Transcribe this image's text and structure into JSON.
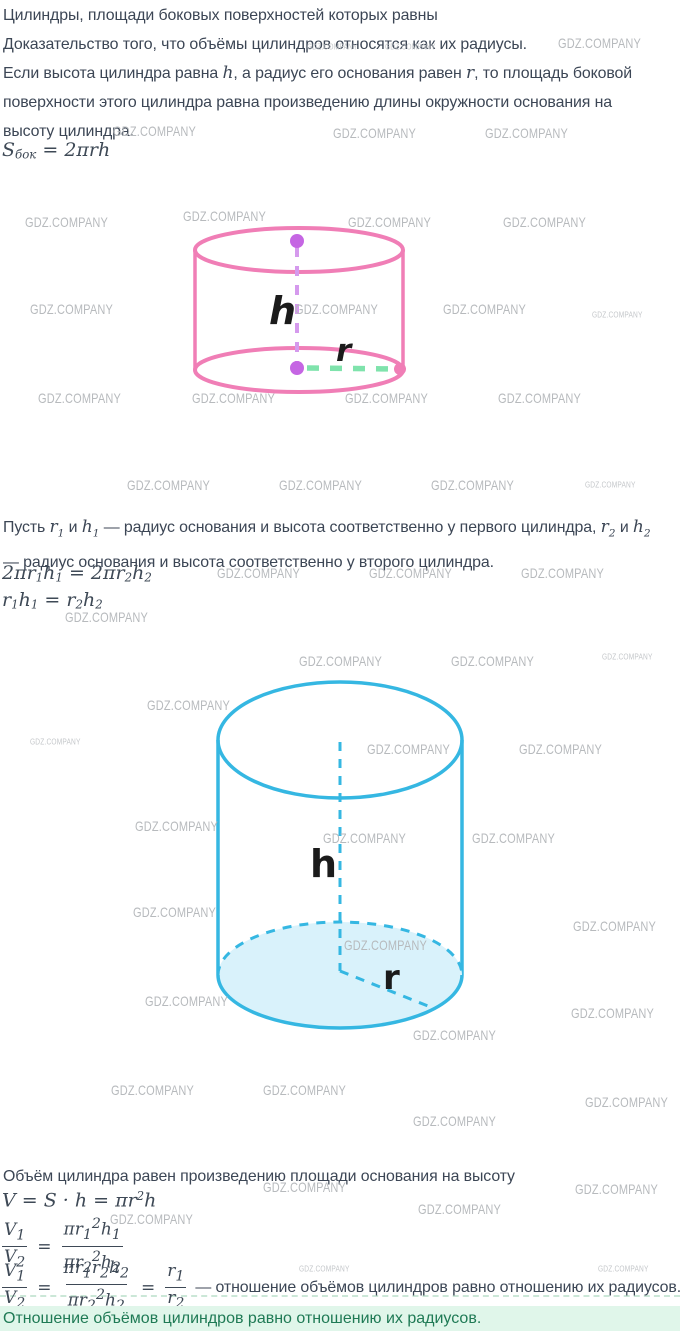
{
  "watermarks": {
    "text": "GDZ.COMPANY",
    "items": [
      [
        307,
        42,
        1
      ],
      [
        385,
        42,
        1
      ],
      [
        558,
        36,
        0
      ],
      [
        113,
        124,
        0
      ],
      [
        333,
        126,
        0
      ],
      [
        485,
        126,
        0
      ],
      [
        25,
        215,
        0
      ],
      [
        183,
        209,
        0
      ],
      [
        348,
        215,
        0
      ],
      [
        503,
        215,
        0
      ],
      [
        30,
        302,
        0
      ],
      [
        295,
        302,
        0
      ],
      [
        443,
        302,
        0
      ],
      [
        592,
        310,
        1
      ],
      [
        38,
        391,
        0
      ],
      [
        192,
        391,
        0
      ],
      [
        345,
        391,
        0
      ],
      [
        498,
        391,
        0
      ],
      [
        127,
        478,
        0
      ],
      [
        279,
        478,
        0
      ],
      [
        431,
        478,
        0
      ],
      [
        585,
        480,
        1
      ],
      [
        217,
        566,
        0
      ],
      [
        369,
        566,
        0
      ],
      [
        521,
        566,
        0
      ],
      [
        65,
        610,
        0
      ],
      [
        299,
        654,
        0
      ],
      [
        451,
        654,
        0
      ],
      [
        602,
        652,
        1
      ],
      [
        147,
        698,
        0
      ],
      [
        30,
        737,
        1
      ],
      [
        367,
        742,
        0
      ],
      [
        519,
        742,
        0
      ],
      [
        135,
        819,
        0
      ],
      [
        323,
        831,
        0
      ],
      [
        472,
        831,
        0
      ],
      [
        133,
        905,
        0
      ],
      [
        573,
        919,
        0
      ],
      [
        344,
        938,
        0
      ],
      [
        145,
        994,
        0
      ],
      [
        571,
        1006,
        0
      ],
      [
        413,
        1028,
        0
      ],
      [
        111,
        1083,
        0
      ],
      [
        263,
        1083,
        0
      ],
      [
        585,
        1095,
        0
      ],
      [
        413,
        1114,
        0
      ],
      [
        263,
        1180,
        0
      ],
      [
        575,
        1182,
        0
      ],
      [
        418,
        1202,
        0
      ],
      [
        110,
        1212,
        0
      ],
      [
        299,
        1264,
        1
      ],
      [
        598,
        1264,
        1
      ]
    ]
  },
  "intro": {
    "line1": "Цилиндры, площади боковых поверхностей которых равны",
    "line2": "Доказательство того, что объёмы цилиндров относятся как их радиусы.",
    "line3_pre": "Если высота цилиндра равна ",
    "var_h": "h",
    "line3_mid": ", а радиус его основания равен ",
    "var_r": "r",
    "line3_post": ", то площадь боковой",
    "line4": "поверхности этого цилиндра равна произведению длины окружности основания на",
    "line5": "высоту цилиндра."
  },
  "middle": {
    "line1_pre": "Пусть ",
    "var_r1": "r_1",
    "and1": " и ",
    "var_h1": "h_1",
    "line1_mid": " — радиус основания и высота соответственно у первого цилиндра, ",
    "var_r2": "r_2",
    "and2": " и ",
    "var_h2": "h_2",
    "line2": "— радиус основания и высота соответственно у второго цилиндра."
  },
  "volume_section": {
    "heading": "Объём цилиндра равен произведению площади основания на высоту"
  },
  "formulas": {
    "s_side": "S_{бок} = 2πrh",
    "eq1": "2πr_1h_1 = 2πr_2h_2",
    "eq2": "r_1h_1 = r_2h_2",
    "volume": "V = S · h = πr^2h",
    "ratio1": {
      "n1": "V_1",
      "d1": "V_2",
      "eq": "=",
      "n2": "πr_1^2h_1",
      "d2": "πr_2^2h_2"
    },
    "ratio2": {
      "n1": "V_1",
      "d1": "V_2",
      "eq1": "=",
      "n2": "πr_1r_2h_2",
      "d2": "πr_2^2h_2",
      "eq2": "=",
      "n3": "r_1",
      "d3": "r_2",
      "tail": "— отношение объёмов цилиндров равно отношению их радиусов."
    }
  },
  "pink_cylinder": {
    "h_label": "h",
    "r_label": "r"
  },
  "blue_cylinder": {
    "h_label": "h",
    "r_label": "r"
  },
  "callout": {
    "text": "Отношение объёмов цилиндров равно отношению их радиусов."
  },
  "colors": {
    "pink": "#F07EB6",
    "violet_dot": "#C566E3",
    "violet_dash": "#D59AED",
    "green_dash": "#7FE3AC",
    "blue": "#35B7E2",
    "blue_fill": "#D9F2FB",
    "label": "#1b1b1b",
    "callout_bg": "#E0F6EA",
    "callout_text": "#1F7A55",
    "body_text": "#3C4655",
    "watermark": "#B7BABD"
  }
}
